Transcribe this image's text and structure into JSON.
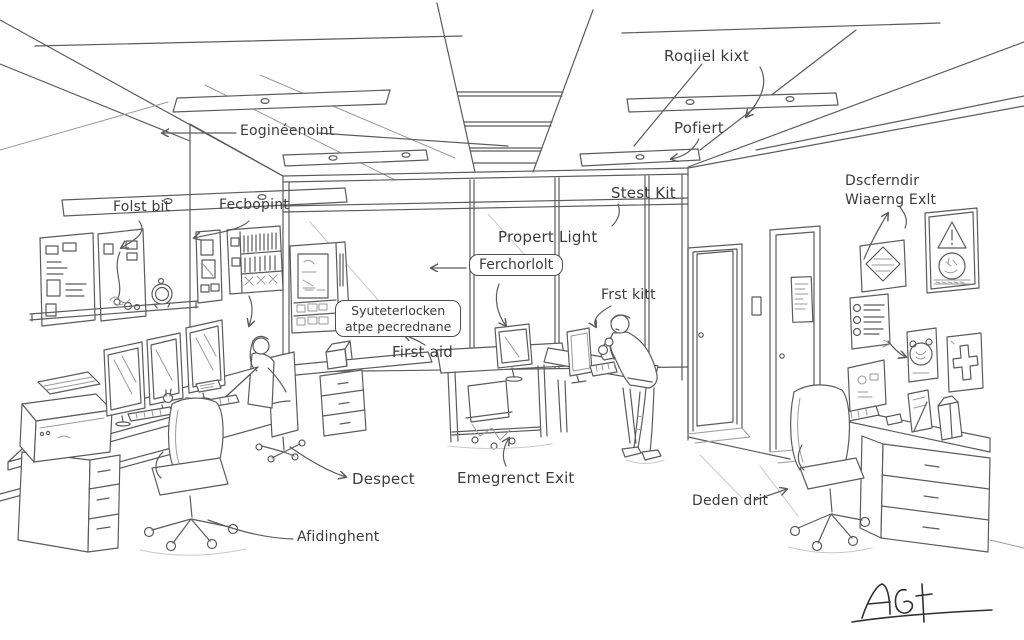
{
  "scene": {
    "description": "Hand-drawn pencil sketch of an open-plan office with safety annotation labels",
    "ink_color": "#5b5b5b",
    "background": "#ffffff"
  },
  "labels": {
    "ceiling_right": "Roqiiel kixt",
    "ceiling_right_lower": "Pofiert",
    "ceiling_left": "Eoginéenoint",
    "left_wall_board": "Folst bit",
    "left_wall_cabinet": "Fecbopint",
    "window_top": "Stest Kit",
    "window_light": "Propert Light",
    "partition_tag": "Ferchorlolt",
    "standing_desk": "Frst kitt",
    "first_aid_cabinet_box": {
      "line1": "Syuteterlocken",
      "line2": "atpe pecrednane"
    },
    "first_aid": "First aid",
    "exit_sign": {
      "line1": "Dscferndir",
      "line2": "Wiaerng Exlt"
    },
    "front_chair": "Despect",
    "under_desk": "Emegrenct Exit",
    "right_chair": "Deden drit",
    "drawer_leader": "Afidinghent",
    "signature": "AG"
  }
}
